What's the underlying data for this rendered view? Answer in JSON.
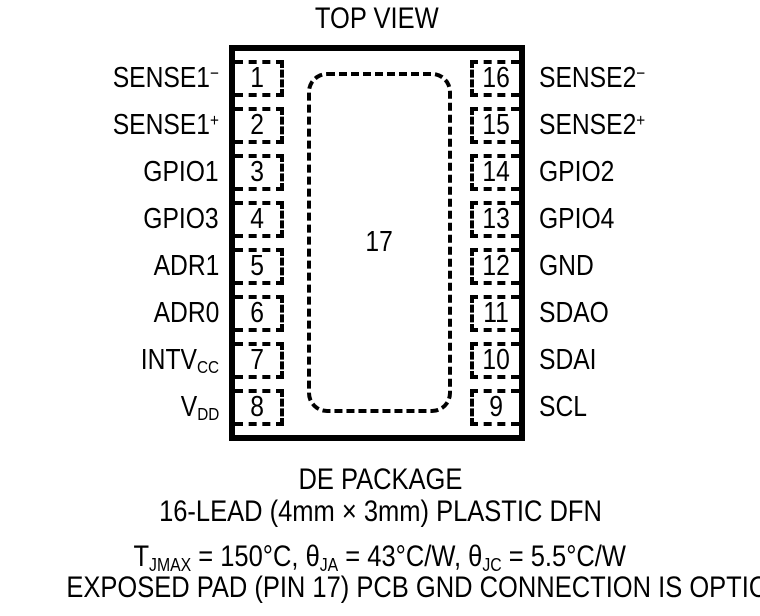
{
  "title": "TOP VIEW",
  "exposed_pad_number": "17",
  "pins": {
    "left": [
      {
        "number": "1",
        "base": "SENSE1",
        "sup": "−",
        "sub": ""
      },
      {
        "number": "2",
        "base": "SENSE1",
        "sup": "+",
        "sub": ""
      },
      {
        "number": "3",
        "base": "GPIO1",
        "sup": "",
        "sub": ""
      },
      {
        "number": "4",
        "base": "GPIO3",
        "sup": "",
        "sub": ""
      },
      {
        "number": "5",
        "base": "ADR1",
        "sup": "",
        "sub": ""
      },
      {
        "number": "6",
        "base": "ADR0",
        "sup": "",
        "sub": ""
      },
      {
        "number": "7",
        "base": "INTV",
        "sup": "",
        "sub": "CC"
      },
      {
        "number": "8",
        "base": "V",
        "sup": "",
        "sub": "DD"
      }
    ],
    "right": [
      {
        "number": "16",
        "base": "SENSE2",
        "sup": "−",
        "sub": ""
      },
      {
        "number": "15",
        "base": "SENSE2",
        "sup": "+",
        "sub": ""
      },
      {
        "number": "14",
        "base": "GPIO2",
        "sup": "",
        "sub": ""
      },
      {
        "number": "13",
        "base": "GPIO4",
        "sup": "",
        "sub": ""
      },
      {
        "number": "12",
        "base": "GND",
        "sup": "",
        "sub": ""
      },
      {
        "number": "11",
        "base": "SDAO",
        "sup": "",
        "sub": ""
      },
      {
        "number": "10",
        "base": "SDAI",
        "sup": "",
        "sub": ""
      },
      {
        "number": "9",
        "base": "SCL",
        "sup": "",
        "sub": ""
      }
    ]
  },
  "captions": {
    "package_name": "DE PACKAGE",
    "package_desc": "16-LEAD (4mm × 3mm) PLASTIC DFN",
    "note": "EXPOSED PAD (PIN 17) PCB GND CONNECTION IS OPTIONAL"
  },
  "thermal": {
    "t1": "T",
    "sub1": "JMAX",
    "t2": " = 150°C, θ",
    "sub2": "JA",
    "t3": " = 43°C/W, θ",
    "sub3": "JC",
    "t4": " = 5.5°C/W"
  },
  "colors": {
    "ink": "#000000",
    "background": "#ffffff"
  }
}
